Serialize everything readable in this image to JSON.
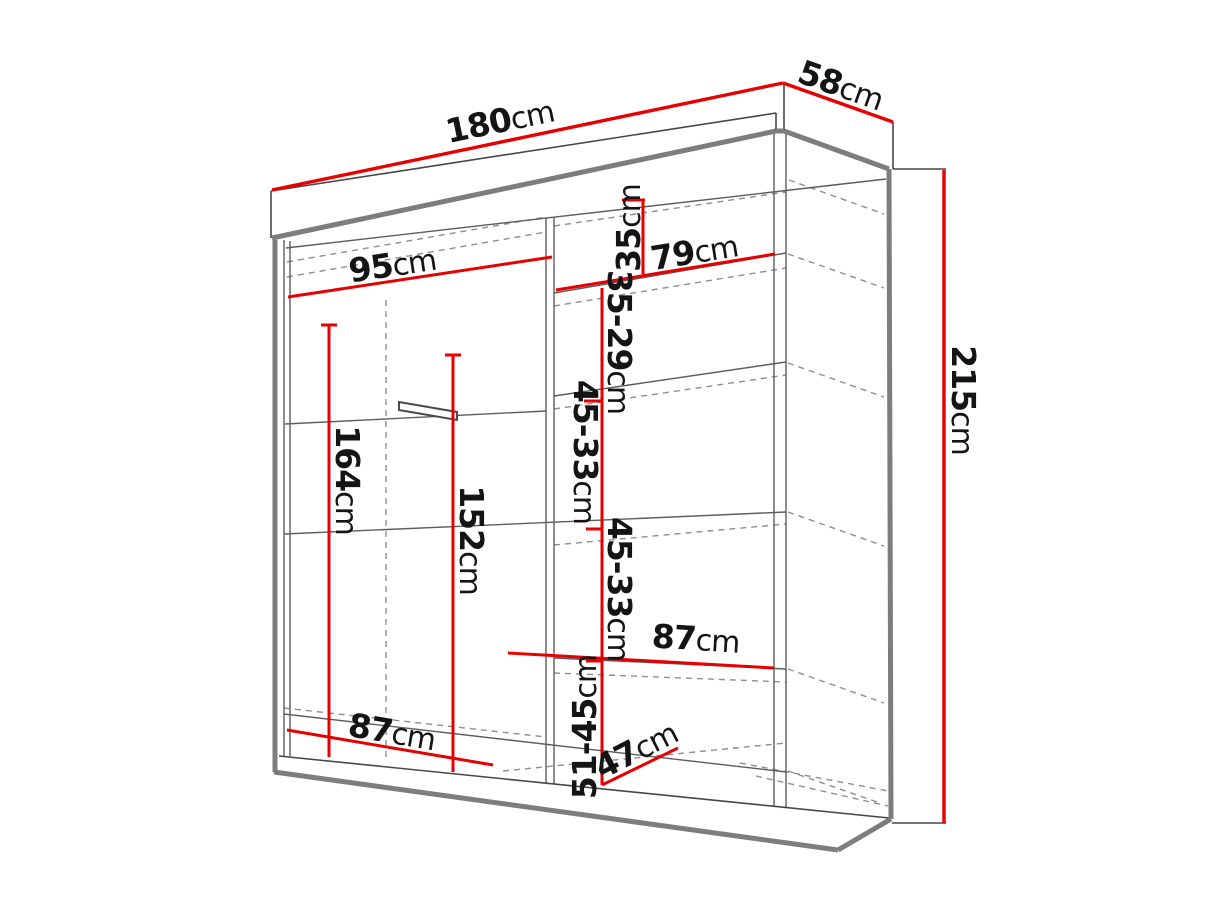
{
  "diagram": {
    "type": "furniture-dimension-diagram",
    "subject": "sliding-door wardrobe line drawing with dimension callouts",
    "unit_default": "cm",
    "colors": {
      "dimension_line": "#e60000",
      "outline": "#474747",
      "edge_thick": "#7d7d7d",
      "hidden_line": "#8e8e8e",
      "label_text": "#141414",
      "background": "#ffffff"
    },
    "dimensions": {
      "overall_width": {
        "value": "180",
        "unit": "cm"
      },
      "overall_depth": {
        "value": "58",
        "unit": "cm"
      },
      "overall_height": {
        "value": "215",
        "unit": "cm"
      },
      "left_section_width": {
        "value": "95",
        "unit": "cm"
      },
      "right_section_width": {
        "value": "79",
        "unit": "cm"
      },
      "top_shelf_height": {
        "value": "35",
        "unit": "cm"
      },
      "upper_shelf_gap": {
        "value": "35-29",
        "unit": "cm"
      },
      "middle_shelf_gap_1": {
        "value": "45-33",
        "unit": "cm"
      },
      "middle_shelf_gap_2": {
        "value": "45-33",
        "unit": "cm"
      },
      "right_shelf_width": {
        "value": "87",
        "unit": "cm"
      },
      "bottom_shelf_gap": {
        "value": "51-45",
        "unit": "cm"
      },
      "bottom_shelf_depth": {
        "value": "47",
        "unit": "cm"
      },
      "left_bottom_width": {
        "value": "87",
        "unit": "cm"
      },
      "left_hanging_height": {
        "value": "164",
        "unit": "cm"
      },
      "left_inner_height": {
        "value": "152",
        "unit": "cm"
      }
    }
  }
}
